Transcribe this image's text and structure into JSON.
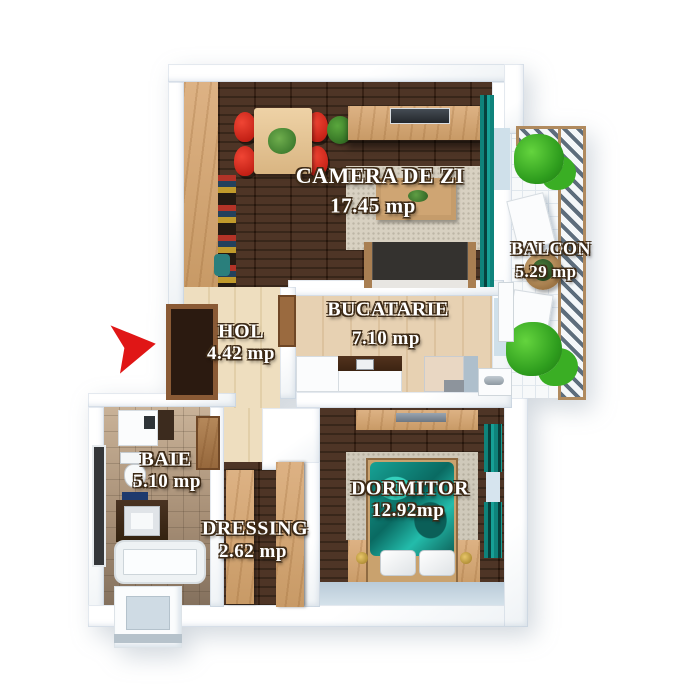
{
  "plan_type": "apartment-floorplan",
  "rooms": [
    {
      "id": "camera-de-zi",
      "name": "CAMERA DE ZI",
      "area": "17.45 mp"
    },
    {
      "id": "bucatarie",
      "name": "BUCATARIE",
      "area": "7.10 mp"
    },
    {
      "id": "hol",
      "name": "HOL",
      "area": "4.42 mp"
    },
    {
      "id": "balcon",
      "name": "BALCON",
      "area": "5.29 mp"
    },
    {
      "id": "baie",
      "name": "BAIE",
      "area": "5.10 mp"
    },
    {
      "id": "dressing",
      "name": "DRESSING",
      "area": "2.62 mp"
    },
    {
      "id": "dormitor",
      "name": "DORMITOR",
      "area": "12.92mp"
    }
  ],
  "entrance": {
    "marker": "red-arrow",
    "color": "#e01616",
    "direction": "right"
  },
  "palette": {
    "dark_wood_floor": "#3a2416",
    "light_wood": "#d4a877",
    "kitchen_floor": "#e4cdab",
    "hol_floor": "#ead9bf",
    "bath_floor": "#a78f76",
    "teal_accent": "#0f837b",
    "chair_red": "#d8231b",
    "wall": "#ffffff",
    "balcony_tile": "#f7f9fa",
    "label_text": "#ffffff"
  }
}
